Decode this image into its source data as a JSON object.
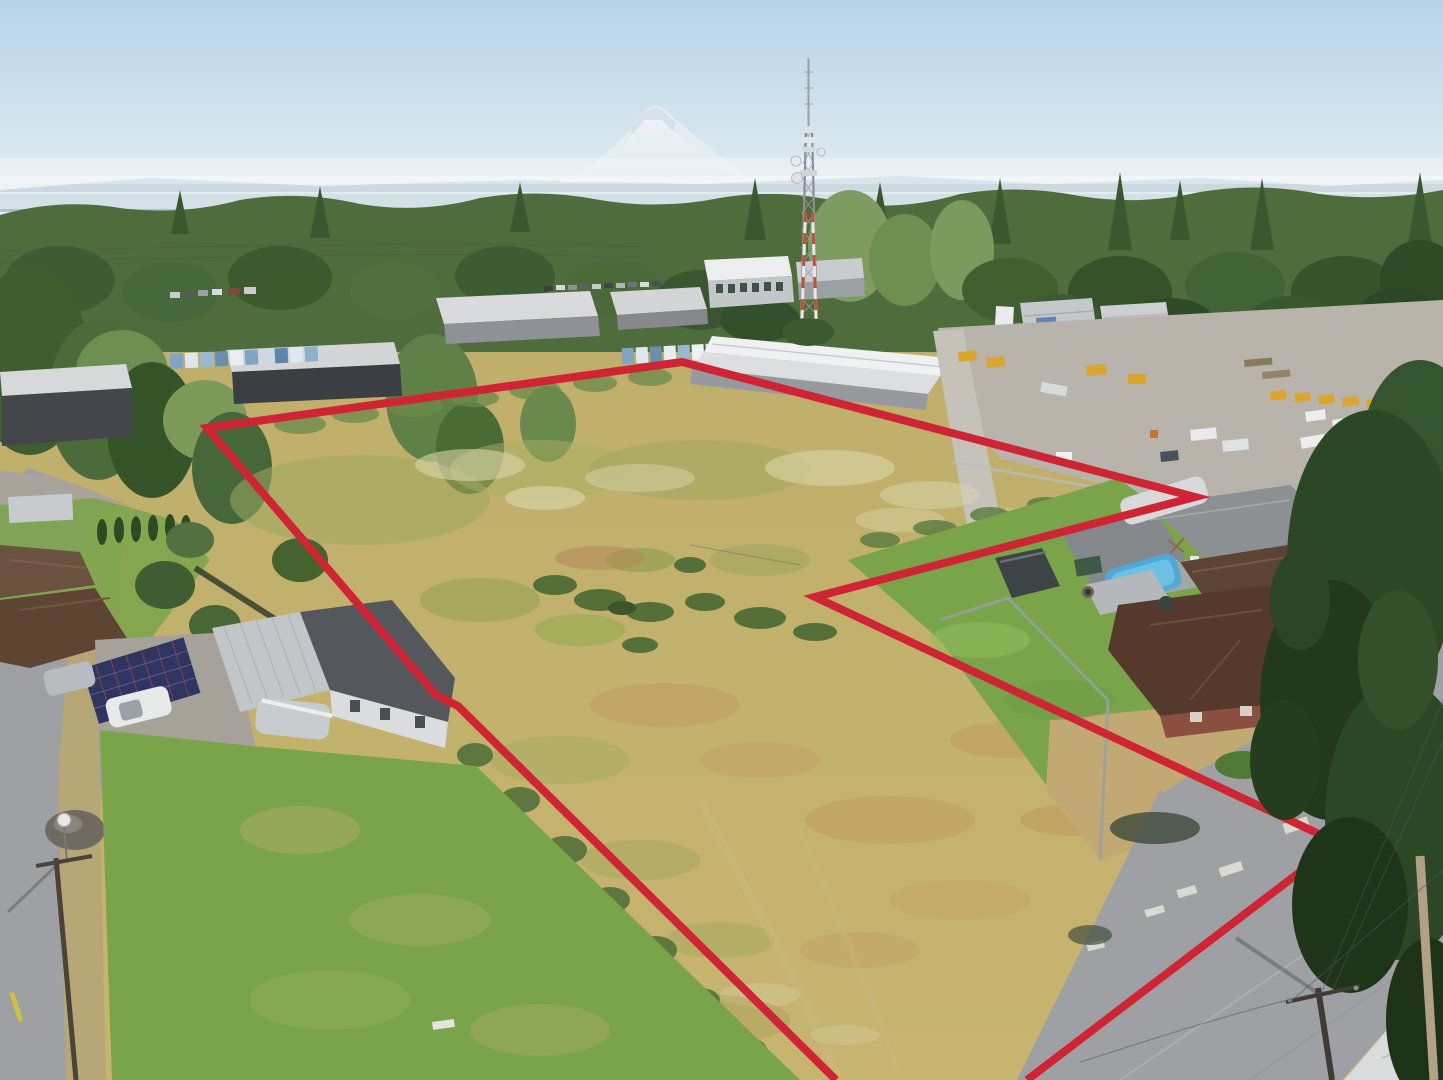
{
  "meta": {
    "title": "Aerial drone photograph of a vacant land parcel outlined in red",
    "media": "photograph",
    "width": 1443,
    "height": 1080,
    "visible_text": "none"
  },
  "boundary": {
    "points": "836,1080 458,706 436,695 207,428 682,362 1195,497 815,597 1338,843 1027,1080",
    "stroke_width": 8,
    "style": "solid"
  },
  "scene": {
    "background": [
      "hazy blue sky",
      "snow-capped volcanic mountain (Mount Rainier)",
      "distant blue ridgeline",
      "evergreen forest treeline"
    ],
    "midground": [
      "steel lattice communications tower with antennas and dishes",
      "industrial warehouses and parking lots",
      "gravel equipment yard with yellow machinery and white trucks",
      "power lines"
    ],
    "subject": [
      "overgrown vacant field: dry golden grass, green patches, white wildflower drifts, scattered dark shrubs, fence lines"
    ],
    "foreground": [
      "house with solar-panel carport, white car and silver car",
      "green lawns",
      "asphalt roads with utility poles and yellow centerline dash",
      "excluded notch with gray-roof house, above-ground pool, two brown-roof houses, shed and trailer",
      "large evergreen tree at right edge",
      "concrete ecology blocks along road frontage",
      "gravel pile and round street sign"
    ]
  },
  "colors": {
    "sky_top": "#b7d3e7",
    "sky_horizon": "#e9f1f4",
    "mountain": "#e6edf2",
    "mountain_shadow": "#cfdce6",
    "ridge": "#a4bac9",
    "valley_haze": "#dce7ec",
    "forest": "#4e6c3c",
    "forest_dark": "#3a5830",
    "forest_light": "#6f8e52",
    "field": "#c2b170",
    "field_green": "#9aa65c",
    "field_flowers": "#dbd6aa",
    "field_dry": "#c19a62",
    "shrub": "#4c6a34",
    "lawn": "#79a44a",
    "road": "#9ea0a3",
    "sidewalk": "#dadbdc",
    "gravel": "#b8b4ab",
    "roof_white": "#eceeef",
    "roof_warehouse_gray": "#b3b6b9",
    "wall_dark": "#4e5256",
    "roof_house_gray": "#8c9093",
    "roof_brown": "#5c4334",
    "roof_brown_dark": "#54392c",
    "metal_roof": "#c3c6c8",
    "solar_panel": "#2e3560",
    "pool": "#4fa8d8",
    "equipment_yellow": "#d9a72e",
    "container_red": "#a84430",
    "tower_steel": "#878d93",
    "tower_red": "#c05038",
    "wire": "#4a5560",
    "pole_wood": "#b3a184",
    "boundary_red": "#cf2433",
    "evergreen": "#2c4726",
    "block_concrete": "#d9dad2"
  }
}
